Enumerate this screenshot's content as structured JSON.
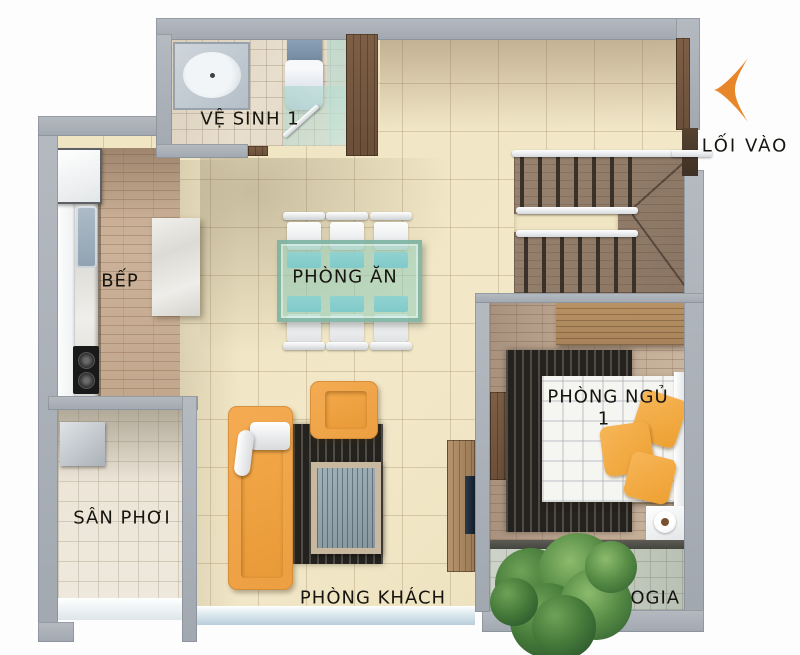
{
  "plan": {
    "type": "apartment-floor-plan",
    "rooms": {
      "bathroom": {
        "label": "VỆ SINH 1"
      },
      "kitchen": {
        "label": "BẾP"
      },
      "dining_room": {
        "label": "PHÒNG ĂN"
      },
      "bedroom": {
        "label": "PHÒNG NGỦ",
        "number": "1"
      },
      "drying_yard": {
        "label": "SÂN PHƠI"
      },
      "living_room": {
        "label": "PHÒNG KHÁCH"
      },
      "loggia": {
        "label": "LOGIA"
      }
    },
    "entrance": {
      "label": "LỐI VÀO",
      "arrow_direction": "left"
    },
    "colors": {
      "wall_gray": "#a9afb6",
      "floor_tile_beige": "#f0e6c4",
      "accent_orange_furniture": "#f0a54c",
      "entrance_arrow_orange": "#e8872a",
      "dining_glass_teal": "#9ed2bf",
      "chair_cushion_blue": "#82d3ea",
      "plant_green": "#3f7a3f"
    }
  }
}
